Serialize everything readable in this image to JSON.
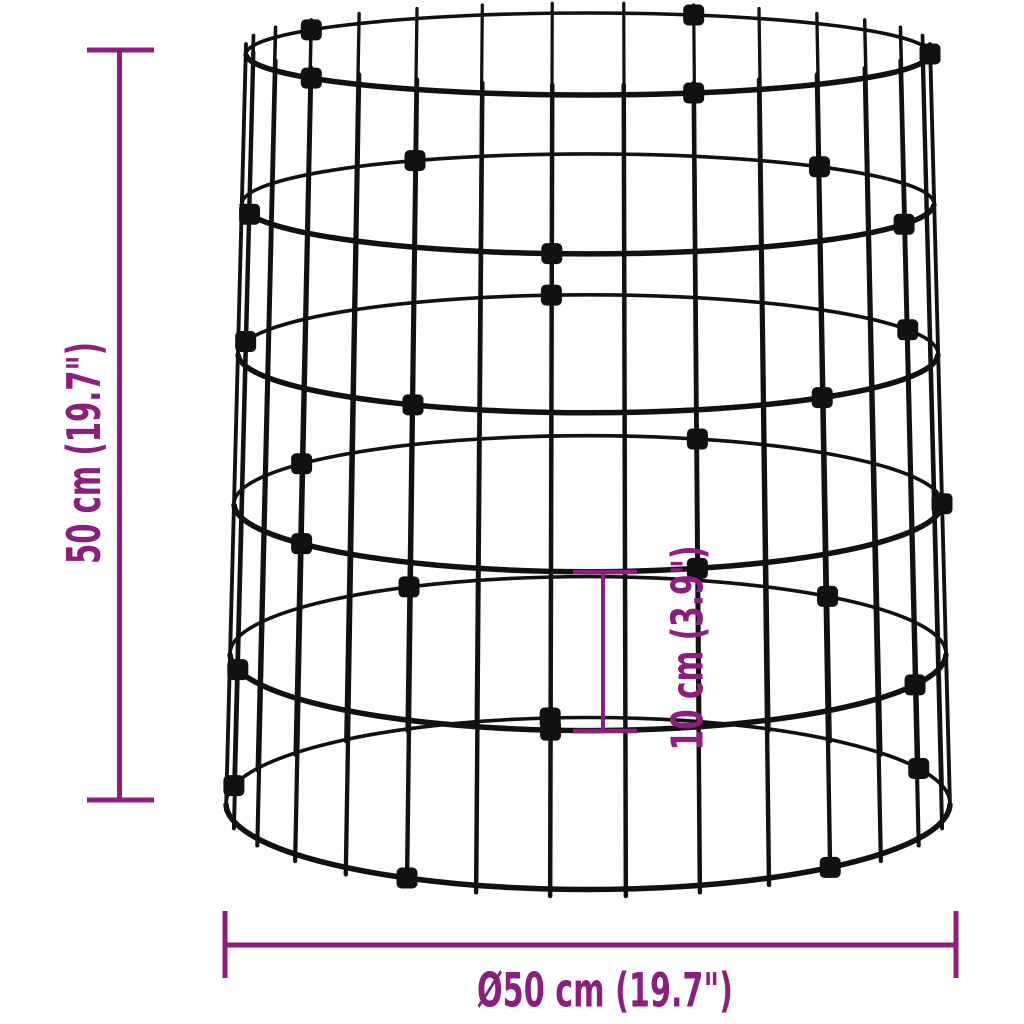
{
  "diagram": {
    "kind": "product-dimension-diagram",
    "subject": "cylindrical-wire-gabion-basket",
    "dimensions": {
      "height_label": "50 cm (19.7\")",
      "diameter_label": "Ø50 cm (19.7\")",
      "ring_spacing_label": "10 cm (3.9\")"
    },
    "colors": {
      "dimension_accent": "#8C1F7D",
      "wire": "#111111",
      "background": "#FFFFFF"
    },
    "structure": {
      "ring_count": 6,
      "vertical_wire_count": 30,
      "clip_interval": 6
    }
  }
}
